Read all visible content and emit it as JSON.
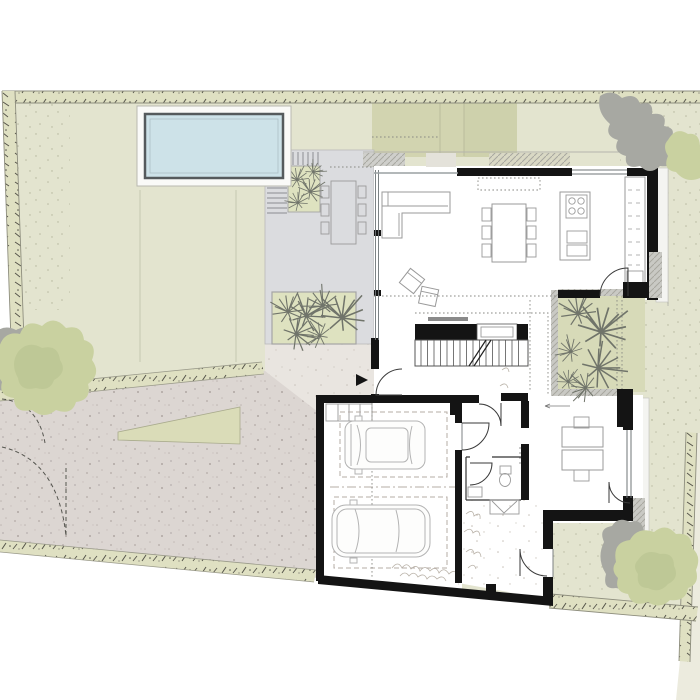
{
  "plan": {
    "type": "architectural-site-plan-ground-floor",
    "colors": {
      "page": "#ffffff",
      "grass": "#e3e4cf",
      "grassDark": "#d2d4b0",
      "edgeStrip": "#dfe0c2",
      "gravel": "#dcd6d2",
      "path": "#e9e5e0",
      "terrace": "#dbdcdf",
      "planting": "#dee2c0",
      "courtyard": "#d7dab8",
      "poolWater": "#cde2e8",
      "poolBorder": "#555a5c",
      "poolDeck": "#fafaf8",
      "wall": "#141414",
      "furniture": "#9a9a9a",
      "treeGreen": "#c9d1a0",
      "treeGreen2": "#bcc693",
      "treeShadow": "#a7a8a2",
      "hatch": "#c9c9c4",
      "glazing": "#6f7577",
      "wedge": "#ecebde"
    },
    "elements": [
      "site-boundary",
      "swimming-pool",
      "pool-deck",
      "lawn",
      "driveway",
      "entry-gate",
      "planting-wedge",
      "terrace",
      "outdoor-dining-table",
      "terrace-planting-bed",
      "entry-path",
      "entrance-arrow",
      "living-room",
      "l-shaped-sofa",
      "lounge-chairs",
      "dining-table",
      "kitchen-island",
      "cooktop",
      "kitchen-counter",
      "staircase",
      "tv-media-wall",
      "courtyard-garden",
      "grass-plants",
      "hallway",
      "wc",
      "toilet",
      "wardrobe",
      "office",
      "double-desk",
      "garage",
      "car-suv",
      "car-sedan",
      "storage-shelf",
      "trees"
    ],
    "counts": {
      "trees": 3,
      "cars": 2,
      "dining_chairs_inside": 6,
      "dining_chairs_outside": 6
    }
  }
}
